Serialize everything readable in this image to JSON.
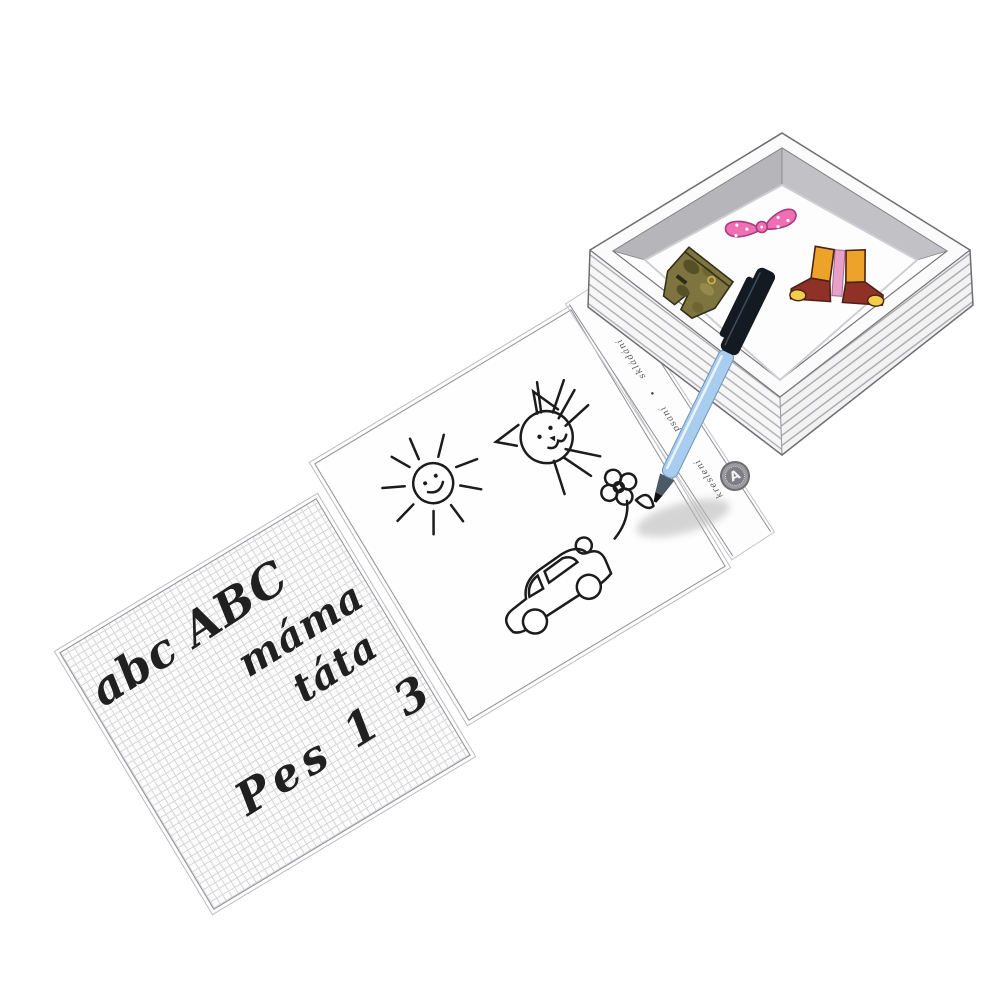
{
  "product": {
    "writing_panel": {
      "lines": [
        "abc ABC",
        "máma",
        "táta",
        "Pes 1 3 8"
      ]
    },
    "spine": {
      "words": [
        "kreslení",
        "psaní",
        "skládání"
      ],
      "separator": "•"
    },
    "logo": {
      "letter": "A"
    }
  },
  "objects": {
    "box": "magnetic-box-tray",
    "pieces": [
      "camo-shorts-magnet",
      "pink-bow-magnet",
      "boots-magnet"
    ],
    "pen": "blue-marker-pen",
    "doodles": [
      "sun",
      "cat",
      "flower",
      "car"
    ]
  },
  "colors": {
    "ink": "#1c1c1c",
    "pen_blue": "#a9cdee",
    "pen_blue_dark": "#6f93b8",
    "cap_black": "#141a22",
    "nose_gray": "#4c5a66",
    "bow_pink": "#ef6eb4",
    "bow_outline": "#a63d7f",
    "boots_orange": "#eda32a",
    "boots_red": "#8f3126",
    "boots_pink": "#e9a0c8",
    "toe_gold": "#f2cf4a",
    "shorts_olive": "#7d7440",
    "shorts_dark": "#565026",
    "shorts_light": "#958a4e",
    "wall_gray_left": "#b5b5ba",
    "wall_gray_right": "#c2c2c6",
    "line_gray": "#9b9b9f"
  }
}
